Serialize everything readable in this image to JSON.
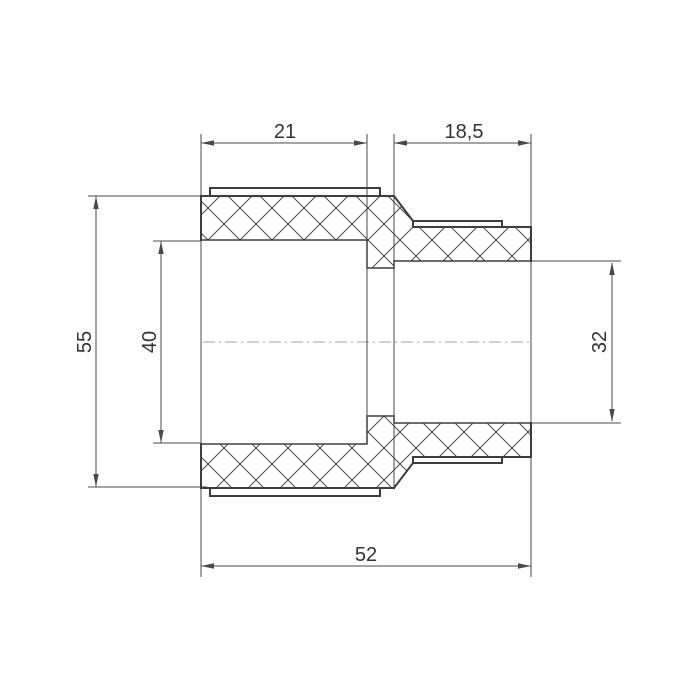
{
  "drawing": {
    "kind": "pipe-fitting-section",
    "dimensions": {
      "socket_length": "21",
      "spigot_length": "18,5",
      "outer_diameter": "55",
      "left_bore_diameter": "40",
      "right_bore_diameter": "32",
      "overall_length": "52"
    },
    "colors": {
      "background": "#ffffff",
      "outline": "#3d3d3d",
      "dimension": "#4a4a4a",
      "text": "#333333",
      "centerline": "#b5b5b5"
    }
  }
}
